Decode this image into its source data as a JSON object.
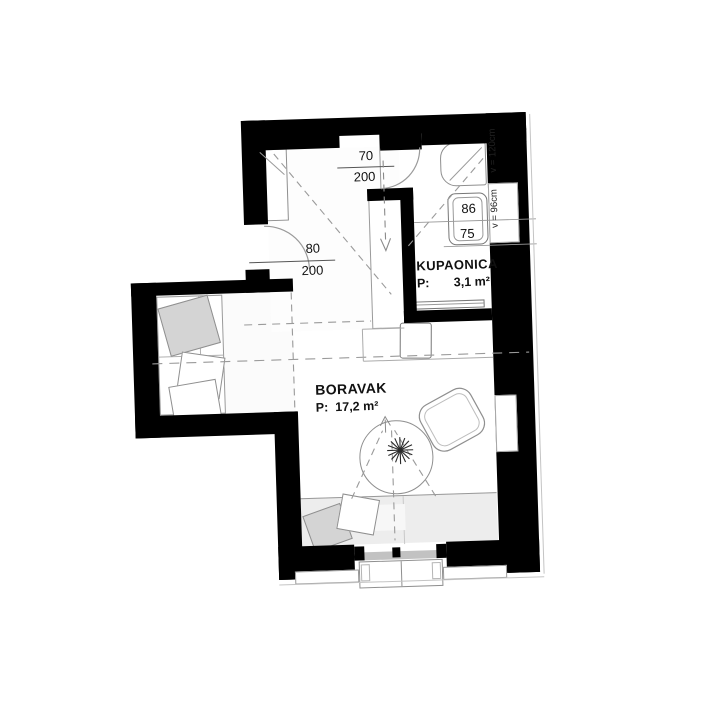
{
  "floor_plan": {
    "rooms": [
      {
        "id": "kupaonica",
        "name": "KUPAONICA",
        "area_label": "P:",
        "area": "3,1 m²"
      },
      {
        "id": "boravak",
        "name": "BORAVAK",
        "area_label": "P:",
        "area": "17,2 m²"
      }
    ],
    "doors": [
      {
        "id": "entry-door-top",
        "width": "70",
        "height": "200"
      },
      {
        "id": "side-door-left",
        "width": "80",
        "height": "200"
      }
    ],
    "fixtures": [
      {
        "id": "washbasin",
        "width": "86",
        "depth": "75"
      }
    ],
    "window_heights": [
      {
        "id": "upper-window",
        "label": "v = 120cm"
      },
      {
        "id": "bath-window",
        "label": "v = 96cm"
      }
    ],
    "colors": {
      "wall": "#000000",
      "thin_line": "#8f8f8f",
      "dashed_line": "#9a9a9a",
      "sofa_fill": "#ededed",
      "pillow_gray": "#d4d4d4",
      "sill_gray": "#c2c2c2"
    }
  }
}
